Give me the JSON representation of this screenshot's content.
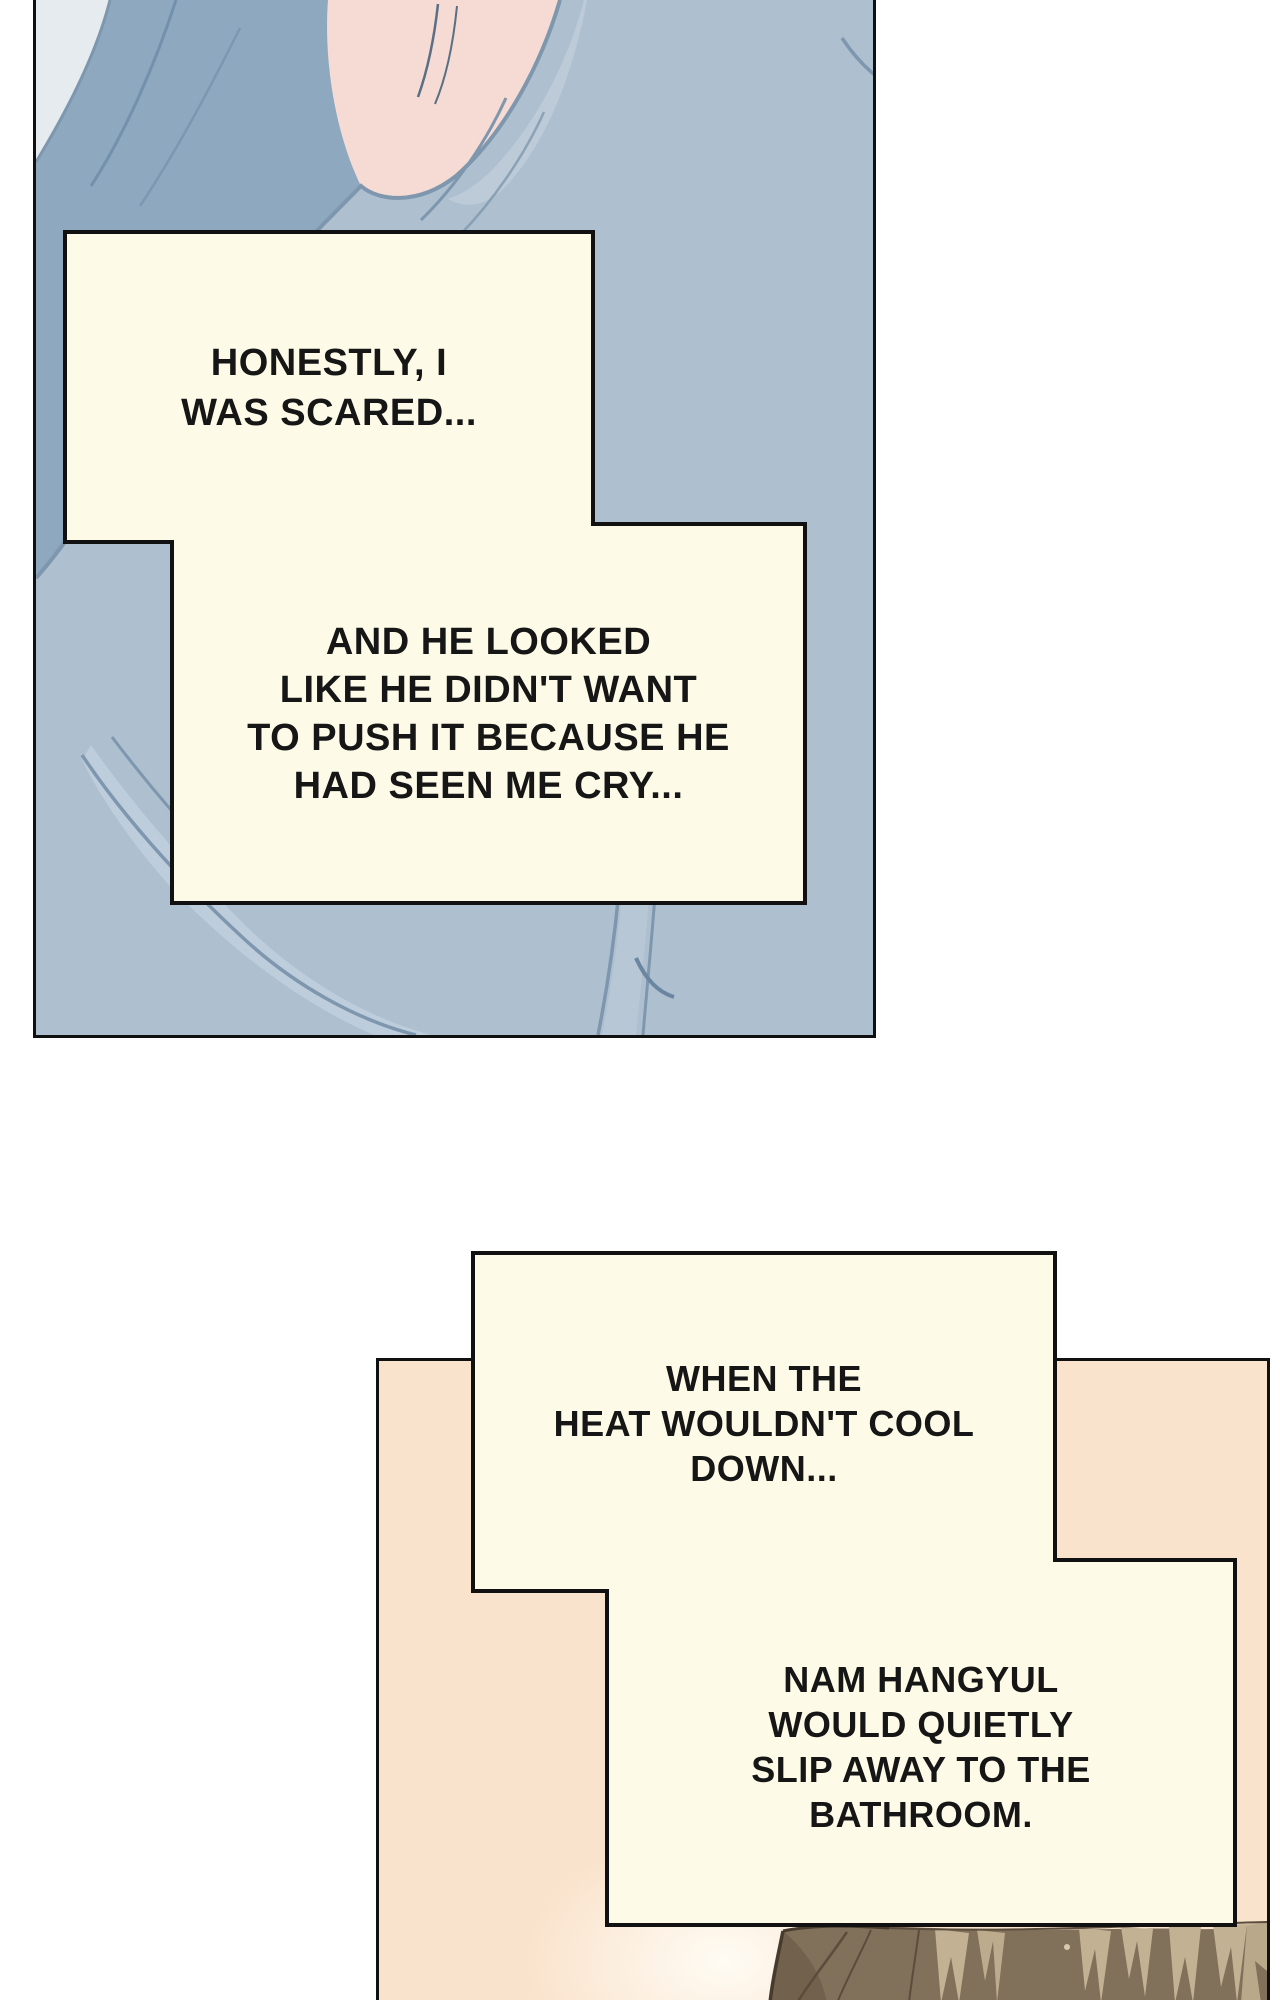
{
  "page": {
    "kind": "webtoon-comic-page",
    "background_color": "#ffffff",
    "width": 1280,
    "height": 2000
  },
  "panels": [
    {
      "id": "panel-1",
      "description": "close-up of pale blue bedding pulled over a sleeping person, small area of skin at the nape visible at top",
      "colors": {
        "blanket": "#aec0d0",
        "blanket_shadow": "#8da8bf",
        "fold_line": "#7e97ae",
        "fold_highlight": "#bfcdda",
        "skin": "#f5dbd3",
        "corner_sheet": "#e6ebef",
        "border": "#101010"
      }
    },
    {
      "id": "panel-2",
      "description": "peach room background with the top of a brown-haired head entering from the bottom edge",
      "colors": {
        "background": "#fae3cc",
        "hair_base": "#81705a",
        "hair_dark": "#5a4d3b",
        "hair_outline": "#463b2c",
        "hair_highlight": "#c3b193",
        "border": "#101010"
      }
    }
  ],
  "captions": [
    {
      "id": "caption-1a",
      "panel": "panel-1",
      "text": "HONESTLY, I\nWAS SCARED..."
    },
    {
      "id": "caption-1b",
      "panel": "panel-1",
      "text": "AND HE LOOKED\nLIKE HE DIDN'T WANT\nTO PUSH IT BECAUSE HE\nHAD SEEN ME CRY..."
    },
    {
      "id": "caption-2a",
      "panel": "panel-2",
      "text": "WHEN THE\nHEAT WOULDN'T COOL\nDOWN..."
    },
    {
      "id": "caption-2b",
      "panel": "panel-2",
      "text": "NAM HANGYUL\nWOULD QUIETLY\nSLIP AWAY TO THE\nBATHROOM."
    }
  ],
  "caption_style": {
    "fill": "#fdfbe7",
    "border_color": "#111111",
    "text_color": "#161616"
  }
}
